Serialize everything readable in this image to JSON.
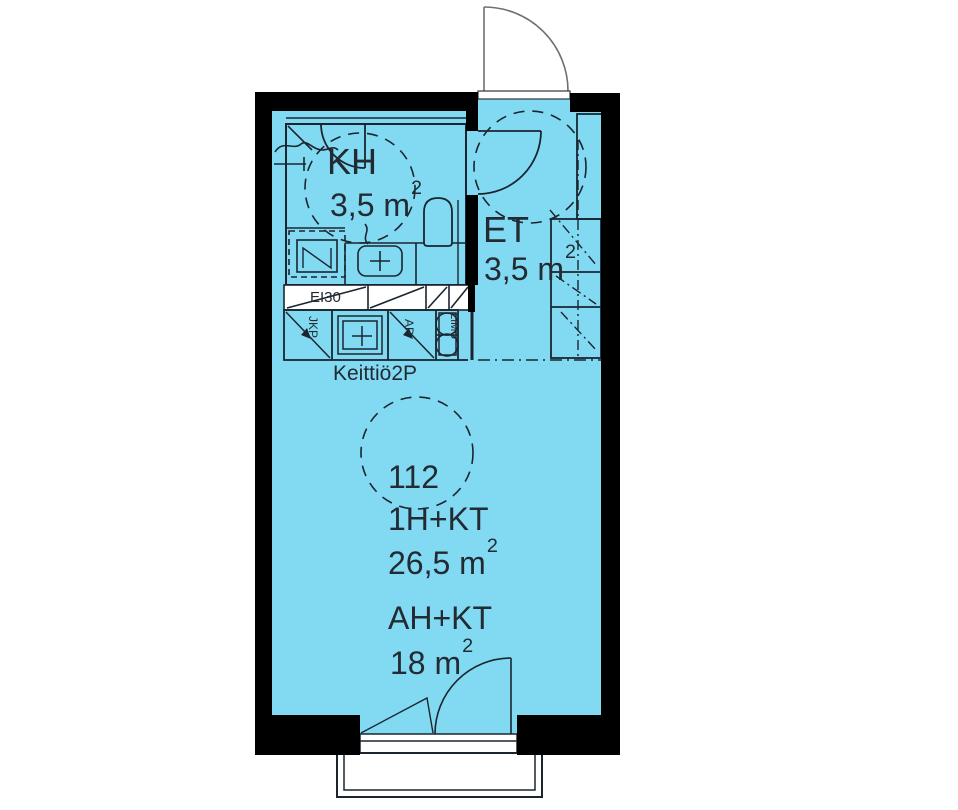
{
  "floorplan": {
    "bathroom": {
      "label": "KH",
      "area": "3,5 m",
      "area_exp": "2"
    },
    "entry": {
      "label": "ET",
      "area": "3,5 m",
      "area_exp": "2"
    },
    "kitchen": {
      "label": "Keittiö2P",
      "fire_rating": "EI30",
      "fridge": "JKP",
      "dishwasher": "AP",
      "stove": "LIMU"
    },
    "apartment": {
      "number": "112",
      "type": "1H+KT",
      "area": "26,5 m",
      "area_exp": "2",
      "living_label": "AH+KT",
      "living_area": "18 m",
      "living_area_exp": "2"
    },
    "colors": {
      "floor": "#82daf2",
      "wall": "#000000",
      "line": "#1a2530",
      "text": "#222a33"
    }
  }
}
